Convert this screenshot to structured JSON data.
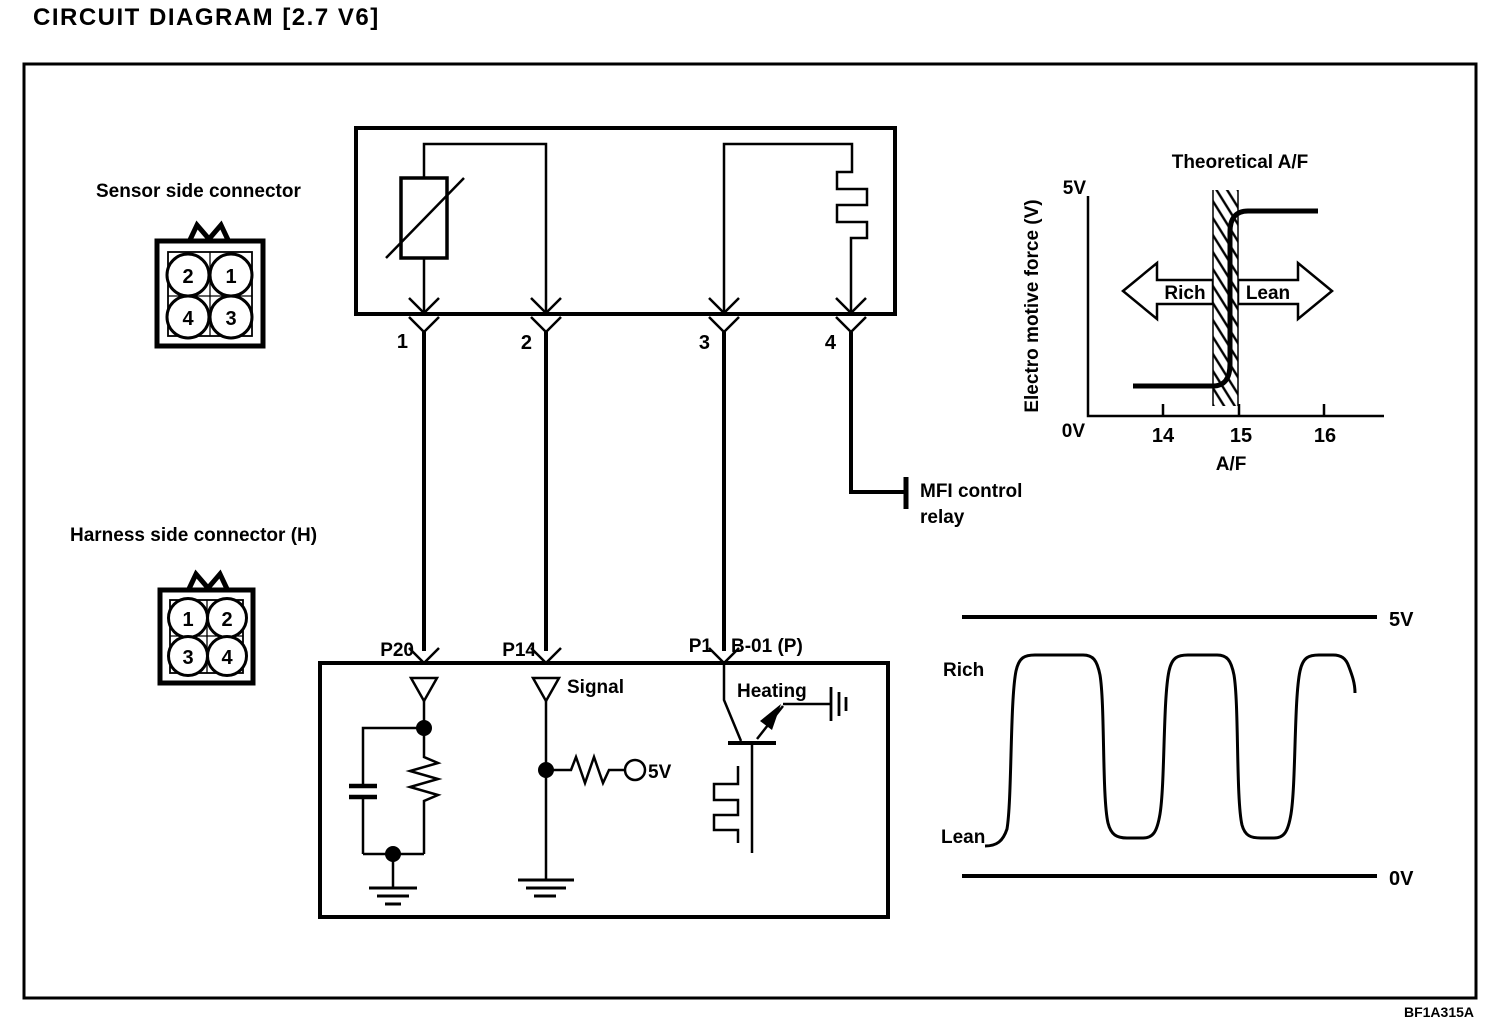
{
  "title": "CIRCUIT DIAGRAM [2.7 V6]",
  "figure_code": "BF1A315A",
  "colors": {
    "ink": "#000000",
    "paper": "#ffffff"
  },
  "connectors": {
    "sensor": {
      "label": "Sensor side connector",
      "pins": [
        "2",
        "1",
        "4",
        "3"
      ]
    },
    "harness": {
      "label": "Harness side connector (H)",
      "pins": [
        "1",
        "2",
        "3",
        "4"
      ]
    }
  },
  "oxygen_sensor_box": {
    "pins": [
      "1",
      "2",
      "3",
      "4"
    ]
  },
  "ecu_box": {
    "pin_p20": "P20",
    "pin_p14": "P14",
    "pin_p1": "P1",
    "harness_ref": "B-01 (P)",
    "signal_label": "Signal",
    "heating_label": "Heating",
    "pullup_voltage": "5V"
  },
  "relay": {
    "line1": "MFI control",
    "line2": "relay"
  },
  "chart_data": [
    {
      "type": "line",
      "title": "Theoretical A/F",
      "xlabel": "A/F",
      "ylabel": "Electro motive force (V)",
      "x_ticks": [
        "14",
        "15",
        "16"
      ],
      "y_top_label": "5V",
      "y_bottom_label": "0V",
      "annotations": [
        "Rich",
        "Lean"
      ],
      "xlim": [
        13.2,
        16.8
      ],
      "ylim": [
        0,
        5
      ],
      "hatched_band_x": [
        14.65,
        14.98
      ],
      "series": [
        {
          "name": "EMF vs A/F",
          "x": [
            13.6,
            14.6,
            14.75,
            14.9,
            15.9
          ],
          "y": [
            0.7,
            0.7,
            2.5,
            4.65,
            4.65
          ]
        }
      ],
      "legend": "none",
      "grid": false
    },
    {
      "type": "line",
      "title": "",
      "y_top_label": "5V",
      "y_bottom_label": "0V",
      "annotations": [
        "Rich",
        "Lean"
      ],
      "ylim": [
        0,
        5
      ],
      "series": [
        {
          "name": "Sensor output oscillation",
          "approx_high_v": 4.2,
          "approx_low_v": 0.8,
          "cycles": 3
        }
      ],
      "legend": "none",
      "grid": false
    }
  ]
}
